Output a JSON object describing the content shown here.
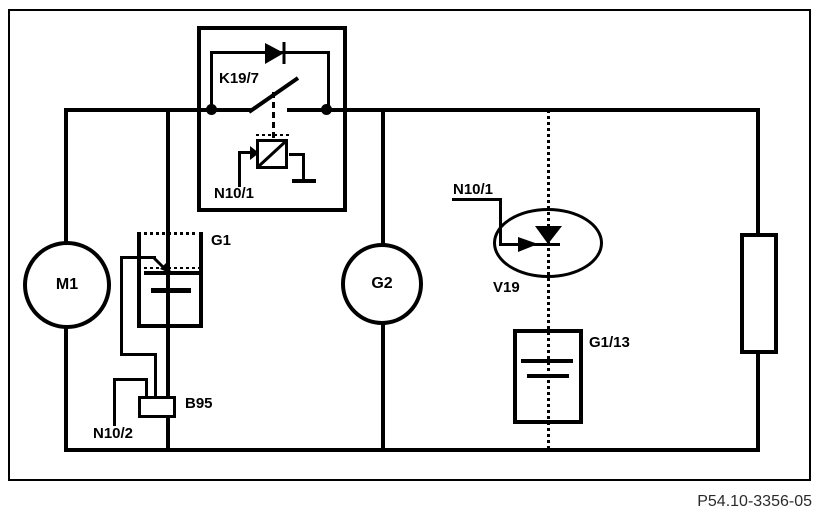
{
  "title": "Wiring diagram",
  "part_number": "P54.10-3356-05",
  "colors": {
    "line": "#000000",
    "background": "#ffffff",
    "text": "#000000"
  },
  "components": {
    "relay_k19_7": {
      "label": "K19/7"
    },
    "relay_control_unit": {
      "label": "N10/1"
    },
    "motor_m1": {
      "label": "M1"
    },
    "battery_g1": {
      "label": "G1"
    },
    "sensor_b95": {
      "label": "B95"
    },
    "control_unit_n10_2": {
      "label": "N10/2"
    },
    "generator_g2": {
      "label": "G2"
    },
    "diode_v19": {
      "label": "V19"
    },
    "led_control_unit": {
      "label": "N10/1"
    },
    "battery_g1_13": {
      "label": "G1/13"
    }
  },
  "symbols": {
    "relay_diode": "right-pointing solid triangle with cathode bar",
    "relay_switch": "diagonal blade contact on supply bus",
    "relay_coil": "square with diagonal, dashed actuation line, ground symbol",
    "battery_g1_symbol": "long/short plate pair with arrow feed",
    "battery_g1_13_symbol": "long/short plate pair in box",
    "v19_symbol": "down-pointing diode triangle with right arrow inside ellipse",
    "resistor": "tall empty rectangle on right rail",
    "junction_dots": 2
  }
}
